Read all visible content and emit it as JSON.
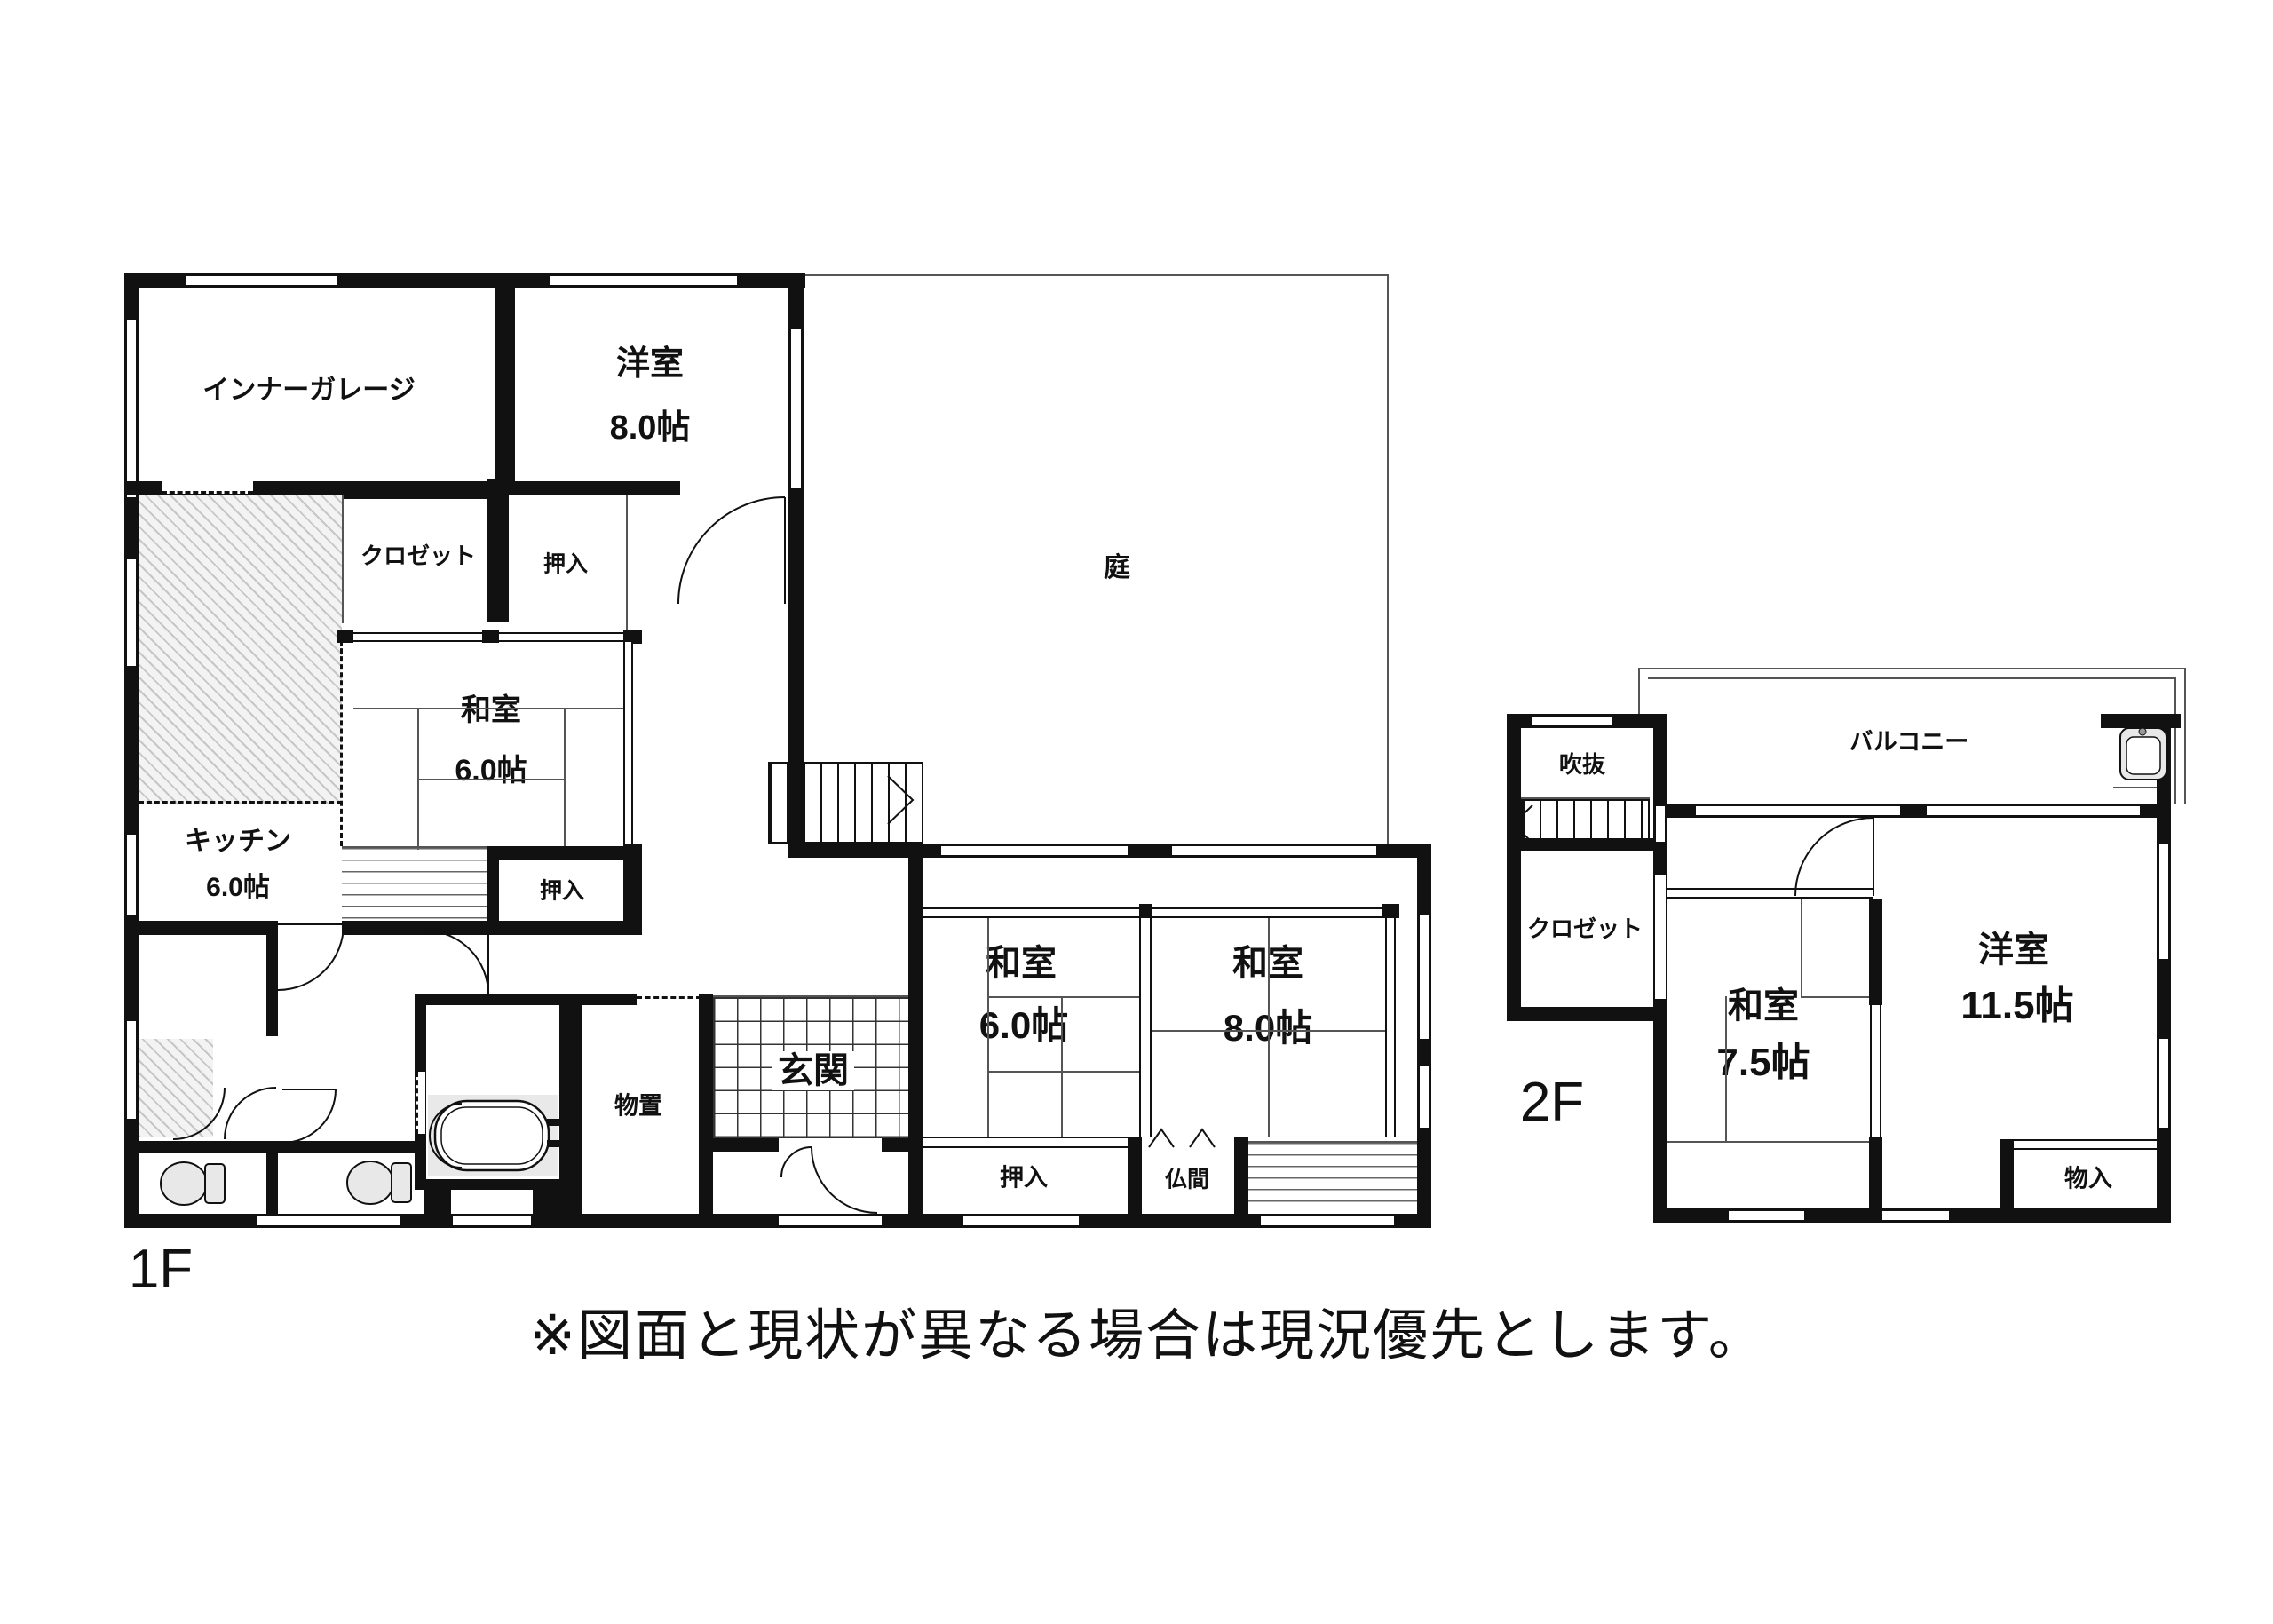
{
  "note": "※図面と現状が異なる場合は現況優先とします。",
  "floors": {
    "f1": {
      "label": "1F",
      "rooms": {
        "garage": {
          "name": "インナーガレージ"
        },
        "west_room": {
          "name": "洋室",
          "size": "8.0帖"
        },
        "garden": {
          "name": "庭"
        },
        "closet": {
          "name": "クロゼット"
        },
        "oshiire_top": {
          "name": "押入"
        },
        "washitsu_nw": {
          "name": "和室",
          "size": "6.0帖"
        },
        "kitchen": {
          "name": "キッチン",
          "size": "6.0帖"
        },
        "oshiire_mid": {
          "name": "押入"
        },
        "washitsu_center": {
          "name": "和室",
          "size": "6.0帖"
        },
        "washitsu_east": {
          "name": "和室",
          "size": "8.0帖"
        },
        "genkan": {
          "name": "玄関"
        },
        "storage": {
          "name": "物置"
        },
        "oshiire_south": {
          "name": "押入"
        },
        "butsuma": {
          "name": "仏間"
        }
      }
    },
    "f2": {
      "label": "2F",
      "rooms": {
        "void": {
          "name": "吹抜"
        },
        "balcony": {
          "name": "バルコニー"
        },
        "closet": {
          "name": "クロゼット"
        },
        "washitsu": {
          "name": "和室",
          "size": "7.5帖"
        },
        "west_room": {
          "name": "洋室",
          "size": "11.5帖"
        },
        "storage": {
          "name": "物入"
        }
      }
    }
  }
}
